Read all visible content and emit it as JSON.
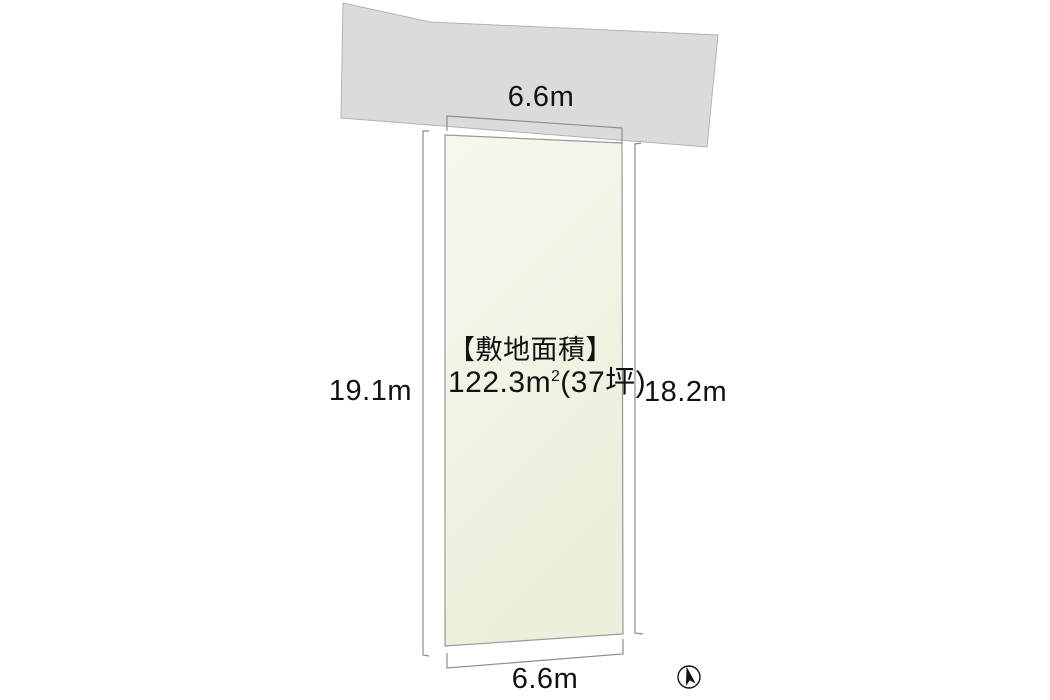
{
  "colors": {
    "background": "#ffffff",
    "road_fill": "#dbdbdb",
    "road_edge": "#b3b3b3",
    "plot_fill_top": "#f6f8ee",
    "plot_fill_bottom": "#eaf0db",
    "plot_edge": "#999999",
    "dimension_line": "#8c8c8c",
    "text": "#111111",
    "compass": "#111111"
  },
  "diagram": {
    "dimensions": {
      "top_width": "6.6m",
      "left_depth": "19.1m",
      "right_depth": "18.2m",
      "bottom_width": "6.6m"
    },
    "area": {
      "title": "【敷地面積】",
      "value": "122.3m",
      "value_sup": "2",
      "tsubo_suffix": "(37坪)"
    },
    "compass_icon": "north-arrow"
  }
}
